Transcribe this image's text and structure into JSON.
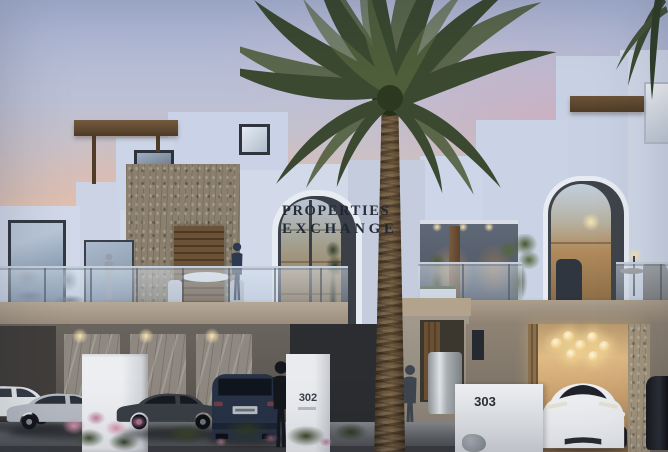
{
  "scene": {
    "type": "real-estate twilight photograph",
    "description": "Modern white townhouses at dusk with a tall palm tree, balconies with residents, and cars parked in the driveways"
  },
  "watermark": {
    "line1": "PROPERTIES",
    "line2": "EXCHANGE",
    "color": "#1d2533"
  },
  "units": [
    {
      "number": "302"
    },
    {
      "number": "303"
    }
  ],
  "palette": {
    "sky_top": "#a9b5d5",
    "sky_glow": "#f2cba9",
    "wall_light": "#d2daea",
    "wall_shade": "#c8d1e3",
    "stone": "#8b7f6d",
    "wood": "#6e553b",
    "fascia": "#a89a88",
    "marble": "#8f8881",
    "warm_interior": "#caa068",
    "palm_foliage": "#3a4930",
    "palm_trunk": "#5e4c37",
    "road": "#5b5e61",
    "car_navy": "#273246",
    "car_silver": "#b6bcc4",
    "car_white": "#e4e7ea",
    "flowers": "#c785a3"
  }
}
